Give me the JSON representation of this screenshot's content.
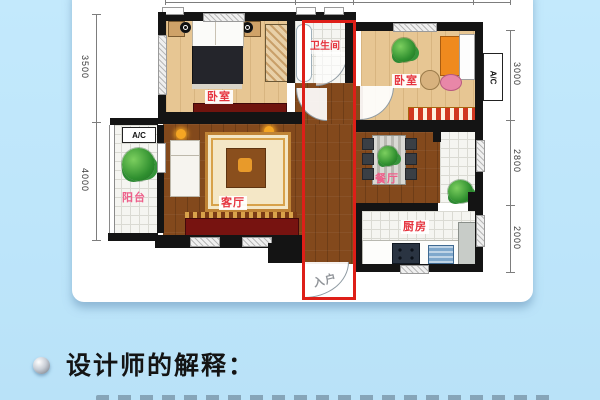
{
  "floorplan": {
    "rooms": {
      "bedroom_left": "卧室",
      "bathroom": "卫生间",
      "bedroom_right": "卧室",
      "balcony": "阳台",
      "living": "客厅",
      "dining": "餐厅",
      "kitchen": "厨房",
      "entrance": "入户"
    },
    "ac": {
      "left": "A/C",
      "right": "A/C"
    },
    "dimensions": {
      "left": [
        "3500",
        "4000"
      ],
      "right": [
        "3000",
        "2800",
        "2000"
      ]
    },
    "highlight_color": "#de1f18"
  },
  "caption": {
    "title": "设计师的解释："
  }
}
